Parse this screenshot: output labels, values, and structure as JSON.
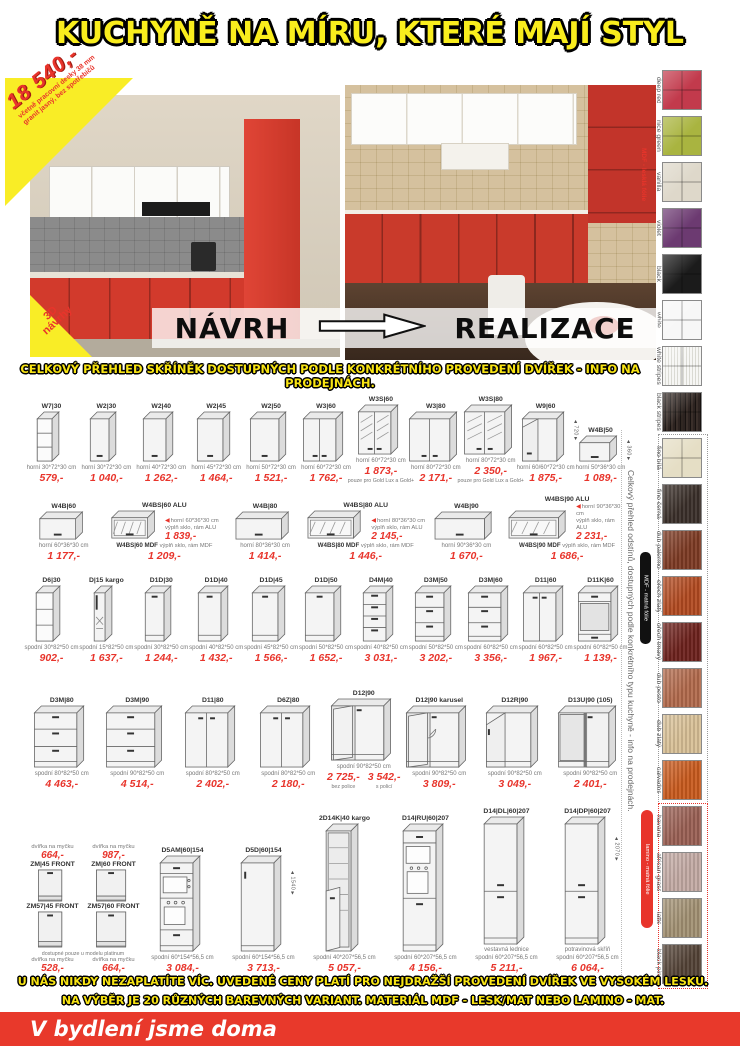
{
  "title": "KUCHYNĚ NA MÍRU, KTERÉ MAJÍ STYL",
  "hero": {
    "price_burst": {
      "price": "18 540,-",
      "note1": "včetně pracovní desky 38 mm",
      "note2": "granit jasný, bez spotřebičů"
    },
    "badge_3d_line1": "3D",
    "badge_3d_line2": "návrhy",
    "navrh_label": "NÁVRH",
    "realizace_label": "REALIZACE"
  },
  "grid_heading": "CELKOVÝ PŘEHLED SKŘÍNĚK DOSTUPNÝCH PODLE KONKRÉTNÍHO PROVEDENÍ DVÍŘEK - INFO NA PRODEJNÁCH.",
  "cabinet_rows": [
    {
      "items": [
        {
          "model": "W7|30",
          "kind": "shelves",
          "hp": "b",
          "w": 22,
          "h": 50,
          "desc": "horní 30*72*30 cm",
          "price": "579,-"
        },
        {
          "model": "W2|30",
          "kind": "door1",
          "hp": "b",
          "w": 26,
          "h": 50,
          "desc": "horní 30*72*30 cm",
          "price": "1 040,-"
        },
        {
          "model": "W2|40",
          "kind": "door1",
          "hp": "b",
          "w": 30,
          "h": 50,
          "desc": "horní 40*72*30 cm",
          "price": "1 262,-"
        },
        {
          "model": "W2|45",
          "kind": "door1",
          "hp": "b",
          "w": 33,
          "h": 50,
          "desc": "horní 45*72*30 cm",
          "price": "1 464,-"
        },
        {
          "model": "W2|50",
          "kind": "door1",
          "hp": "b",
          "w": 36,
          "h": 50,
          "desc": "horní 50*72*30 cm",
          "price": "1 521,-"
        },
        {
          "model": "W3|60",
          "kind": "door2",
          "hp": "b",
          "w": 40,
          "h": 50,
          "desc": "horní 60*72*30 cm",
          "price": "1 762,-"
        },
        {
          "model": "W3S|60",
          "kind": "glass2",
          "hp": "b",
          "w": 40,
          "h": 50,
          "desc": "horní 60*72*30 cm",
          "price": "1 873,-",
          "note": "pouze pro Gold Lux a Gold+"
        },
        {
          "model": "W3|80",
          "kind": "door2",
          "hp": "b",
          "w": 48,
          "h": 50,
          "desc": "horní 80*72*30 cm",
          "price": "2 171,-"
        },
        {
          "model": "W3S|80",
          "kind": "glass2",
          "hp": "b",
          "w": 48,
          "h": 50,
          "desc": "horní 80*72*30 cm",
          "price": "2 350,-",
          "note": "pouze pro Gold Lux a Gold+"
        },
        {
          "model": "W9|60",
          "kind": "cornerwall",
          "hp": "b",
          "w": 42,
          "h": 50,
          "desc": "horní 60/60*72*30 cm",
          "price": "1 875,-",
          "dim": "720"
        },
        {
          "model": "W4B|50",
          "kind": "flap",
          "hp": "b",
          "w": 38,
          "h": 26,
          "desc": "horní 50*36*30 cm",
          "price": "1 089,-",
          "dim": "360"
        }
      ]
    },
    {
      "items": [
        {
          "model": "W4B|60",
          "kind": "flap",
          "hp": "b",
          "w": 44,
          "h": 28,
          "desc": "horní 60*36*30 cm",
          "price": "1 177,-"
        },
        {
          "model": "W4BS|60 ALU",
          "model2": "W4BS|60 MDF",
          "kind": "flapglass",
          "hp": "b",
          "w": 44,
          "h": 28,
          "desc": "horní 60*36*30 cm",
          "line1": "výplň sklo, rám ALU",
          "price": "1 839,-",
          "line2": "výplň sklo, rám MDF",
          "price2": "1 209,-"
        },
        {
          "model": "W4B|80",
          "kind": "flap",
          "hp": "b",
          "w": 54,
          "h": 28,
          "desc": "horní 80*36*30 cm",
          "price": "1 414,-"
        },
        {
          "model": "W4BS|80 ALU",
          "model2": "W4BS|80 MDF",
          "kind": "flapglass",
          "hp": "b",
          "w": 54,
          "h": 28,
          "desc": "horní 80*36*30 cm",
          "line1": "výplň sklo, rám ALU",
          "price": "2 145,-",
          "line2": "výplň sklo, rám MDF",
          "price2": "1 446,-"
        },
        {
          "model": "W4B|90",
          "kind": "flap",
          "hp": "b",
          "w": 58,
          "h": 28,
          "desc": "horní 90*36*30 cm",
          "price": "1 670,-"
        },
        {
          "model": "W4BS|90 ALU",
          "model2": "W4BS|90 MDF",
          "kind": "flapglass",
          "hp": "b",
          "w": 58,
          "h": 28,
          "desc": "horní 90*36*30 cm",
          "line1": "výplň sklo, rám ALU",
          "price": "2 231,-",
          "line2": "výplň sklo, rám MDF",
          "price2": "1 686,-"
        }
      ]
    },
    {
      "items": [
        {
          "model": "D6|30",
          "kind": "shelves",
          "w": 24,
          "h": 56,
          "desc": "spodní 30*82*50 cm",
          "price": "902,-"
        },
        {
          "model": "D|15 kargo",
          "kind": "kargo",
          "w": 18,
          "h": 56,
          "desc": "spodní 15*82*50 cm",
          "price": "1 637,-"
        },
        {
          "model": "D1D|30",
          "kind": "base1",
          "w": 26,
          "h": 56,
          "desc": "spodní 30*82*50 cm",
          "price": "1 244,-"
        },
        {
          "model": "D1D|40",
          "kind": "base1",
          "w": 30,
          "h": 56,
          "desc": "spodní 40*82*50 cm",
          "price": "1 432,-"
        },
        {
          "model": "D1D|45",
          "kind": "base1",
          "w": 33,
          "h": 56,
          "desc": "spodní 45*82*50 cm",
          "price": "1 566,-"
        },
        {
          "model": "D1D|50",
          "kind": "base1",
          "w": 36,
          "h": 56,
          "desc": "spodní 50*82*50 cm",
          "price": "1 652,-"
        },
        {
          "model": "D4M|40",
          "kind": "drawers4",
          "w": 30,
          "h": 56,
          "desc": "spodní 40*82*50 cm",
          "price": "3 031,-"
        },
        {
          "model": "D3M|50",
          "kind": "drawers3",
          "w": 36,
          "h": 56,
          "desc": "spodní 50*82*50 cm",
          "price": "3 202,-"
        },
        {
          "model": "D3M|60",
          "kind": "drawers3",
          "w": 40,
          "h": 56,
          "desc": "spodní 60*82*50 cm",
          "price": "3 356,-"
        },
        {
          "model": "D11|60",
          "kind": "door2",
          "w": 40,
          "h": 56,
          "desc": "spodní 60*82*50 cm",
          "price": "1 967,-"
        },
        {
          "model": "D11K|60",
          "kind": "baseopen",
          "w": 40,
          "h": 56,
          "desc": "spodní 60*82*50 cm",
          "price": "1 139,-"
        }
      ]
    },
    {
      "items": [
        {
          "model": "D3M|80",
          "kind": "drawers3",
          "w": 50,
          "h": 62,
          "desc": "spodní 80*82*50 cm",
          "price": "4 463,-"
        },
        {
          "model": "D3M|90",
          "kind": "drawers3",
          "w": 56,
          "h": 62,
          "desc": "spodní 90*82*50 cm",
          "price": "4 514,-"
        },
        {
          "model": "D11|80",
          "kind": "door2",
          "w": 50,
          "h": 62,
          "desc": "spodní 80*82*50 cm",
          "price": "2 402,-"
        },
        {
          "model": "D6Z|80",
          "kind": "door2",
          "w": 50,
          "h": 62,
          "desc": "spodní 80*82*50 cm",
          "price": "2 180,-"
        },
        {
          "model": "D12|90",
          "kind": "cornerbase",
          "w": 60,
          "h": 62,
          "desc": "spodní 90*82*50 cm",
          "price": "2 725,-",
          "price_note": "bez police",
          "price2": "3 542,-",
          "price2_note": "s policí"
        },
        {
          "model": "D12|90 karusel",
          "kind": "cornerbase",
          "fan": true,
          "w": 60,
          "h": 62,
          "desc": "spodní 90*82*50 cm",
          "price": "3 809,-"
        },
        {
          "model": "D12R|90",
          "kind": "cornerdiag",
          "w": 52,
          "h": 62,
          "desc": "spodní 90*82*50 cm",
          "price": "3 049,-"
        },
        {
          "model": "D13U|90 (105)",
          "kind": "cornerblind",
          "w": 58,
          "h": 62,
          "desc": "spodní 90*82*50 cm",
          "price": "2 401,-"
        }
      ]
    },
    {
      "fronts": {
        "top": [
          {
            "note": "dvířka na myčku",
            "price": "664,-",
            "model": "ZM|45 FRONT",
            "w": 24
          },
          {
            "note": "dvířka na myčku",
            "price": "987,-",
            "model": "ZM|60 FRONT",
            "w": 30
          }
        ],
        "mid": [
          {
            "model": "ZM57|45 FRONT",
            "w": 24
          },
          {
            "model": "ZM57|60 FRONT",
            "w": 30
          }
        ],
        "group_note": "dostupné pouze u modelu platinum",
        "bottom": [
          {
            "note": "dvířka na myčku",
            "price": "528,-"
          },
          {
            "note": "dvířka na myčku",
            "price": "664,-"
          }
        ]
      },
      "items": [
        {
          "model": "D5AM|60|154",
          "kind": "tallovenlow",
          "w": 40,
          "h": 96,
          "desc": "spodní 60*154*56,5 cm",
          "price": "3 084,-"
        },
        {
          "model": "D5D|60|154",
          "kind": "talldoor",
          "w": 40,
          "h": 96,
          "desc": "spodní 60*154*56,5 cm",
          "price": "3 713,-",
          "dim": "1540"
        },
        {
          "model": "2D14K|40 kargo",
          "kind": "tallkargo",
          "w": 32,
          "h": 128,
          "desc": "spodní 40*207*56,5 cm",
          "price": "5 057,-"
        },
        {
          "model": "D14|RU|60|207",
          "kind": "tallovenhigh",
          "w": 40,
          "h": 128,
          "desc": "spodní 60*207*56,5 cm",
          "price": "4 156,-"
        },
        {
          "model": "D14|DL|60|207",
          "kind": "tallsplit",
          "w": 40,
          "h": 128,
          "desc2": "vestavná lednice",
          "desc": "spodní 60*207*56,5 cm",
          "price": "5 211,-"
        },
        {
          "model": "D14|DP|60|207",
          "kind": "tallsplit",
          "w": 40,
          "h": 128,
          "desc2": "potravinová skříň",
          "desc": "spodní 60*207*56,5 cm",
          "price": "6 064,-",
          "dim": "2070"
        }
      ]
    }
  ],
  "sidebar": {
    "vertical_caption": "Celkový přehled odstínů, dostupných podle konkrétního typu kuchyně - info na prodejnách.",
    "mdf_gloss_label": "MDF - lesklá fólie",
    "mdf_mat_label": "MDF - matná fólie",
    "lamino_label": "lamino - matná fólie",
    "swatches": [
      {
        "name": "deep red",
        "color": "#c23a4c",
        "pattern": "plain"
      },
      {
        "name": "nice green",
        "color": "#a9b440",
        "pattern": "plain"
      },
      {
        "name": "vanilla",
        "color": "#ded8ca",
        "pattern": "plain"
      },
      {
        "name": "violet",
        "color": "#6c3a71",
        "pattern": "plain"
      },
      {
        "name": "black",
        "color": "#1b1b1b",
        "pattern": "plain"
      },
      {
        "name": "white",
        "color": "#f7f7f7",
        "pattern": "plain"
      },
      {
        "name": "white stripes",
        "color": "#eceae4",
        "pattern": "stripes-light"
      },
      {
        "name": "black stripes",
        "color": "#2a211d",
        "pattern": "stripes-dark"
      },
      {
        "name": "fino bílá",
        "color": "#e5dec5",
        "pattern": "plain"
      },
      {
        "name": "fino černá",
        "color": "#3a2f29",
        "pattern": "wood"
      },
      {
        "name": "dub palermo",
        "color": "#7d3a23",
        "pattern": "wood"
      },
      {
        "name": "ořech zlatý",
        "color": "#b24a20",
        "pattern": "wood"
      },
      {
        "name": "ořech tmavý",
        "color": "#6d211c",
        "pattern": "wood"
      },
      {
        "name": "dub pesto",
        "color": "#b26a4c",
        "pattern": "wood"
      },
      {
        "name": "dub zlatý",
        "color": "#d8c096",
        "pattern": "wood"
      },
      {
        "name": "calvados",
        "color": "#c95a1d",
        "pattern": "wood"
      },
      {
        "name": "havana",
        "color": "#9a6054",
        "pattern": "wood"
      },
      {
        "name": "african grass",
        "color": "#c3aaa4",
        "pattern": "wood"
      },
      {
        "name": "latte",
        "color": "#a29173",
        "pattern": "wood"
      },
      {
        "name": "black pine",
        "color": "#534236",
        "pattern": "wood"
      }
    ]
  },
  "footer": {
    "line1": "U NÁS NIKDY NEZAPLATÍTE VÍC. UVEDENÉ CENY PLATÍ PRO NEJDRAŽŠÍ PROVEDENÍ DVÍŘEK VE VYSOKÉM LESKU.",
    "line2": "NA VÝBĚR JE 20 RŮZNÝCH BAREVNÝCH VARIANT. MATERIÁL MDF - LESK/MAT NEBO LAMINO - MAT.",
    "tagline": "V bydlení jsme doma"
  }
}
